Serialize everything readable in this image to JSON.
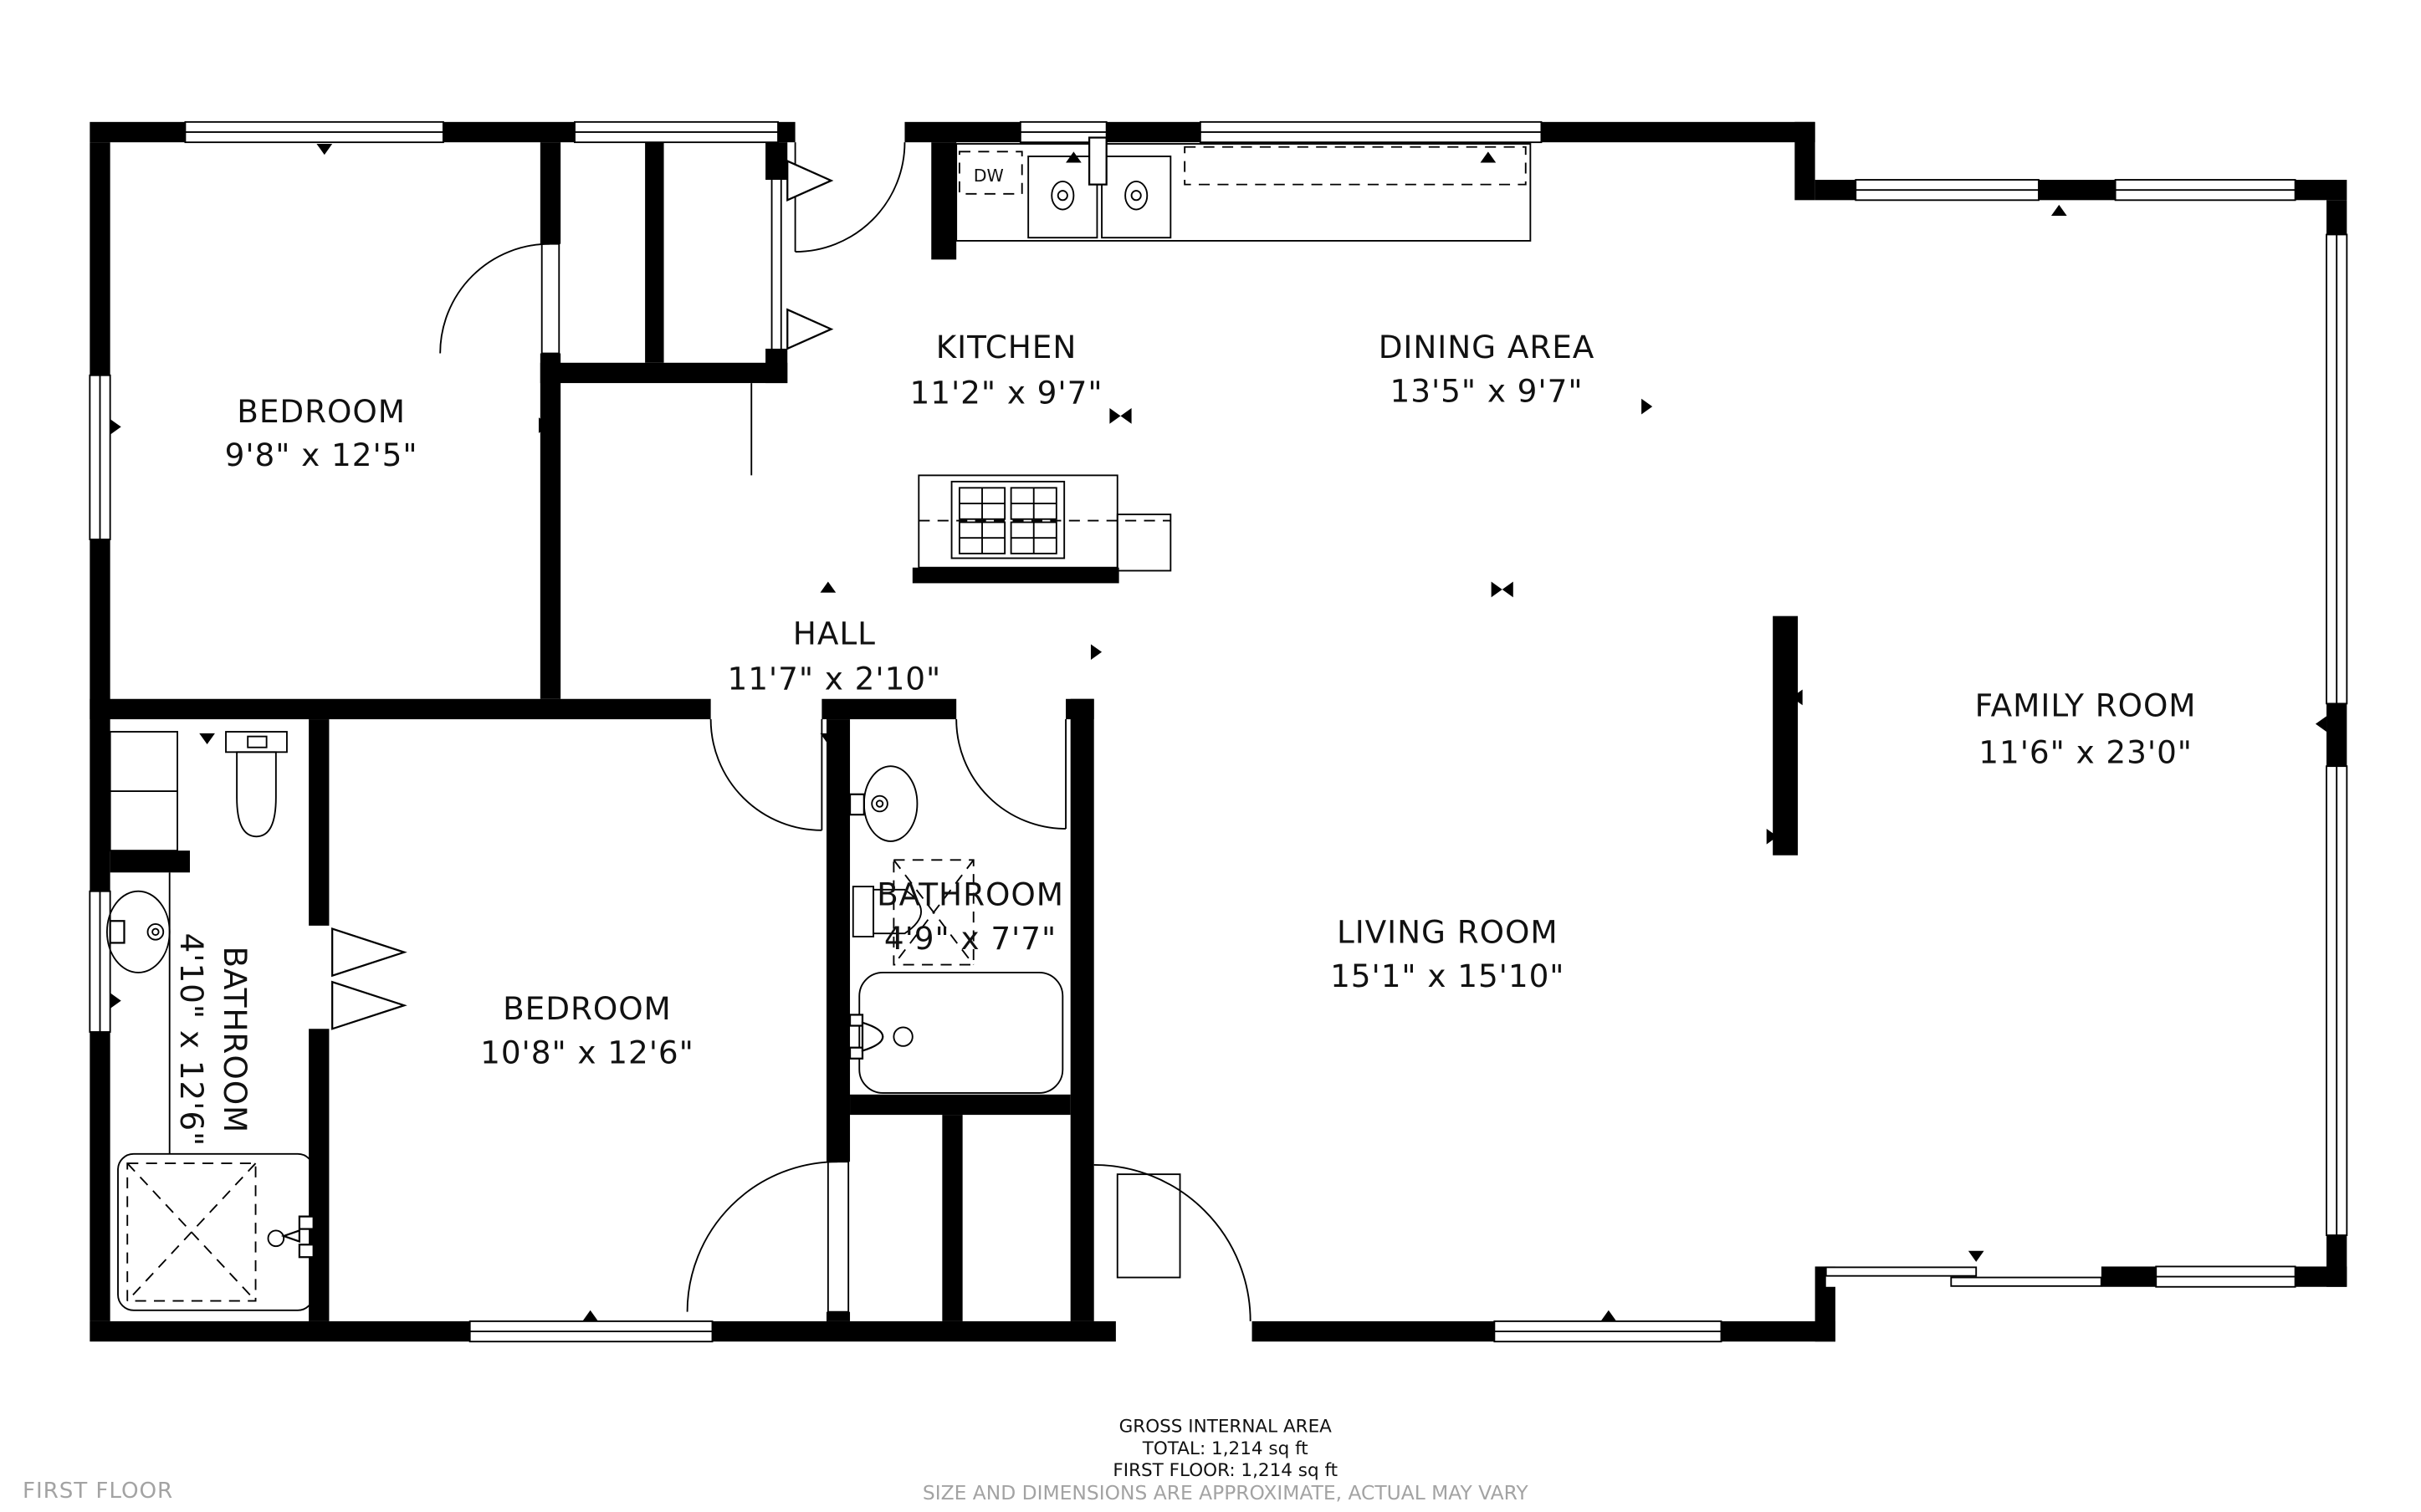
{
  "rooms": [
    {
      "id": "bedroom-top-left",
      "name": "BEDROOM",
      "dims": "9'8\" x 12'5\""
    },
    {
      "id": "kitchen",
      "name": "KITCHEN",
      "dims": "11'2\" x 9'7\""
    },
    {
      "id": "dining-area",
      "name": "DINING AREA",
      "dims": "13'5\" x 9'7\""
    },
    {
      "id": "hall",
      "name": "HALL",
      "dims": "11'7\" x 2'10\""
    },
    {
      "id": "family-room",
      "name": "FAMILY ROOM",
      "dims": "11'6\" x 23'0\""
    },
    {
      "id": "bathroom-left",
      "name": "BATHROOM",
      "dims": "4'10\" x 12'6\""
    },
    {
      "id": "bedroom-bottom",
      "name": "BEDROOM",
      "dims": "10'8\" x 12'6\""
    },
    {
      "id": "bathroom-small",
      "name": "BATHROOM",
      "dims": "4'9\" x 7'7\""
    },
    {
      "id": "living-room",
      "name": "LIVING ROOM",
      "dims": "15'1\" x 15'10\""
    }
  ],
  "kitchen": {
    "dishwasher_label": "DW"
  },
  "footer": {
    "line1": "GROSS INTERNAL AREA",
    "line2": "TOTAL: 1,214 sq ft",
    "line3": "FIRST FLOOR: 1,214 sq ft",
    "disclaimer": "SIZE AND DIMENSIONS ARE APPROXIMATE, ACTUAL MAY VARY"
  },
  "floor_label": "FIRST FLOOR",
  "colors": {
    "wall": "#000000",
    "background": "#ffffff",
    "muted_text": "#a3a3a3"
  }
}
